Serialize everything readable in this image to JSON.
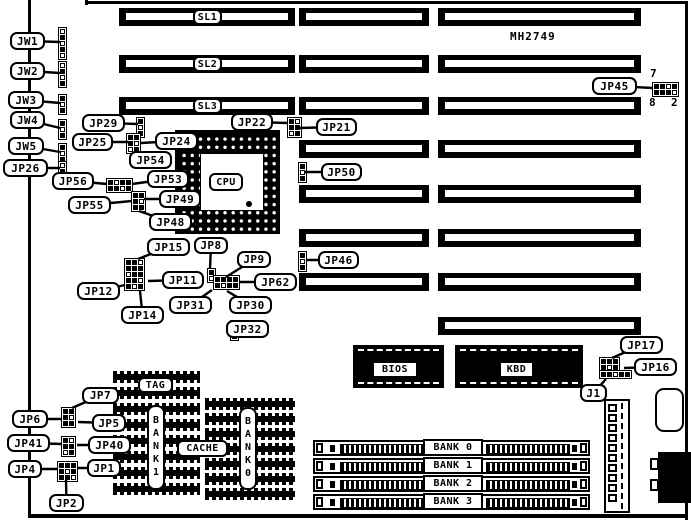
{
  "title": {
    "model": "MH2749"
  },
  "cpu": {
    "label": "CPU"
  },
  "callouts": [
    {
      "id": "jw1",
      "label": "JW1",
      "x": 10,
      "y": 32,
      "w": 35,
      "h": 18,
      "tx": 60,
      "ty": 42
    },
    {
      "id": "jw2",
      "label": "JW2",
      "x": 10,
      "y": 62,
      "w": 35,
      "h": 18,
      "tx": 60,
      "ty": 73
    },
    {
      "id": "jw3",
      "label": "JW3",
      "x": 8,
      "y": 91,
      "w": 36,
      "h": 18,
      "tx": 60,
      "ty": 103
    },
    {
      "id": "jw4",
      "label": "JW4",
      "x": 10,
      "y": 111,
      "w": 35,
      "h": 18,
      "tx": 60,
      "ty": 128
    },
    {
      "id": "jw5",
      "label": "JW5",
      "x": 8,
      "y": 137,
      "w": 36,
      "h": 18,
      "tx": 60,
      "ty": 152
    },
    {
      "id": "jp26",
      "label": "JP26",
      "x": 3,
      "y": 159,
      "w": 45,
      "h": 18,
      "tx": 60,
      "ty": 168
    },
    {
      "id": "jp29",
      "label": "JP29",
      "x": 82,
      "y": 114,
      "w": 43,
      "h": 18,
      "tx": 138,
      "ty": 124
    },
    {
      "id": "jp25",
      "label": "JP25",
      "x": 72,
      "y": 133,
      "w": 41,
      "h": 18,
      "tx": 128,
      "ty": 142
    },
    {
      "id": "jp24",
      "label": "JP24",
      "x": 155,
      "y": 132,
      "w": 43,
      "h": 18,
      "tx": 141,
      "ty": 143
    },
    {
      "id": "jp54",
      "label": "JP54",
      "x": 129,
      "y": 151,
      "w": 43,
      "h": 18,
      "tx": 135,
      "ty": 150
    },
    {
      "id": "jp56",
      "label": "JP56",
      "x": 52,
      "y": 172,
      "w": 42,
      "h": 18,
      "tx": 107,
      "ty": 184
    },
    {
      "id": "jp53",
      "label": "JP53",
      "x": 147,
      "y": 170,
      "w": 42,
      "h": 18,
      "tx": 132,
      "ty": 184
    },
    {
      "id": "jp55",
      "label": "JP55",
      "x": 68,
      "y": 196,
      "w": 43,
      "h": 18,
      "tx": 132,
      "ty": 201
    },
    {
      "id": "jp49",
      "label": "JP49",
      "x": 159,
      "y": 190,
      "w": 42,
      "h": 18,
      "tx": 144,
      "ty": 199
    },
    {
      "id": "jp48",
      "label": "JP48",
      "x": 149,
      "y": 213,
      "w": 43,
      "h": 18,
      "tx": 139,
      "ty": 211
    },
    {
      "id": "jp22",
      "label": "JP22",
      "x": 231,
      "y": 113,
      "w": 42,
      "h": 18,
      "tx": 288,
      "ty": 123
    },
    {
      "id": "jp21",
      "label": "JP21",
      "x": 316,
      "y": 118,
      "w": 41,
      "h": 18,
      "tx": 299,
      "ty": 128
    },
    {
      "id": "jp50",
      "label": "JP50",
      "x": 321,
      "y": 163,
      "w": 41,
      "h": 18,
      "tx": 305,
      "ty": 172
    },
    {
      "id": "jp46",
      "label": "JP46",
      "x": 318,
      "y": 251,
      "w": 41,
      "h": 18,
      "tx": 307,
      "ty": 260
    },
    {
      "id": "jp45",
      "label": "JP45",
      "x": 592,
      "y": 77,
      "w": 45,
      "h": 18,
      "tx": 653,
      "ty": 88
    },
    {
      "id": "jp15",
      "label": "JP15",
      "x": 147,
      "y": 238,
      "w": 43,
      "h": 18,
      "tx": 138,
      "ty": 259
    },
    {
      "id": "jp8",
      "label": "JP8",
      "x": 194,
      "y": 237,
      "w": 34,
      "h": 17,
      "tx": 210,
      "ty": 269
    },
    {
      "id": "jp9",
      "label": "JP9",
      "x": 237,
      "y": 251,
      "w": 34,
      "h": 17,
      "tx": 226,
      "ty": 277
    },
    {
      "id": "jp12",
      "label": "JP12",
      "x": 77,
      "y": 282,
      "w": 43,
      "h": 18,
      "tx": 125,
      "ty": 285
    },
    {
      "id": "jp11",
      "label": "JP11",
      "x": 162,
      "y": 271,
      "w": 42,
      "h": 18,
      "tx": 148,
      "ty": 281
    },
    {
      "id": "jp62",
      "label": "JP62",
      "x": 254,
      "y": 273,
      "w": 43,
      "h": 18,
      "tx": 239,
      "ty": 282
    },
    {
      "id": "jp14",
      "label": "JP14",
      "x": 121,
      "y": 306,
      "w": 43,
      "h": 18,
      "tx": 140,
      "ty": 291
    },
    {
      "id": "jp31",
      "label": "JP31",
      "x": 169,
      "y": 296,
      "w": 43,
      "h": 18,
      "tx": 212,
      "ty": 290
    },
    {
      "id": "jp30",
      "label": "JP30",
      "x": 229,
      "y": 296,
      "w": 43,
      "h": 18,
      "tx": 227,
      "ty": 291
    },
    {
      "id": "jp32",
      "label": "JP32",
      "x": 226,
      "y": 320,
      "w": 43,
      "h": 18,
      "tx": 238,
      "ty": 329
    },
    {
      "id": "jp7",
      "label": "JP7",
      "x": 82,
      "y": 387,
      "w": 37,
      "h": 17,
      "tx": 72,
      "ty": 408
    },
    {
      "id": "jp6",
      "label": "JP6",
      "x": 12,
      "y": 410,
      "w": 36,
      "h": 18,
      "tx": 62,
      "ty": 419
    },
    {
      "id": "jp5",
      "label": "JP5",
      "x": 92,
      "y": 414,
      "w": 34,
      "h": 18,
      "tx": 78,
      "ty": 422
    },
    {
      "id": "jp41",
      "label": "JP41",
      "x": 7,
      "y": 434,
      "w": 43,
      "h": 18,
      "tx": 62,
      "ty": 444
    },
    {
      "id": "jp40",
      "label": "JP40",
      "x": 88,
      "y": 436,
      "w": 43,
      "h": 18,
      "tx": 77,
      "ty": 445
    },
    {
      "id": "jp4",
      "label": "JP4",
      "x": 8,
      "y": 460,
      "w": 34,
      "h": 18,
      "tx": 58,
      "ty": 469
    },
    {
      "id": "jp1",
      "label": "JP1",
      "x": 87,
      "y": 459,
      "w": 34,
      "h": 18,
      "tx": 78,
      "ty": 468
    },
    {
      "id": "jp2",
      "label": "JP2",
      "x": 49,
      "y": 494,
      "w": 35,
      "h": 18,
      "tx": 66,
      "ty": 480
    },
    {
      "id": "jp17",
      "label": "JP17",
      "x": 620,
      "y": 336,
      "w": 43,
      "h": 18,
      "tx": 612,
      "ty": 358
    },
    {
      "id": "jp16",
      "label": "JP16",
      "x": 634,
      "y": 358,
      "w": 43,
      "h": 18,
      "tx": 624,
      "ty": 368
    },
    {
      "id": "j1",
      "label": "J1",
      "x": 580,
      "y": 384,
      "w": 27,
      "h": 18,
      "tx": 606,
      "ty": 379
    }
  ],
  "flat_labels": [
    {
      "id": "sl1",
      "label": "SL1",
      "x": 193,
      "y": 9,
      "w": 29,
      "h": 16,
      "s": "r"
    },
    {
      "id": "sl2",
      "label": "SL2",
      "x": 193,
      "y": 56,
      "w": 29,
      "h": 16,
      "s": "r"
    },
    {
      "id": "sl3",
      "label": "SL3",
      "x": 193,
      "y": 98,
      "w": 29,
      "h": 16,
      "s": "r"
    },
    {
      "id": "cpu",
      "label": "CPU",
      "x": 209,
      "y": 173,
      "w": 34,
      "h": 18,
      "s": "r"
    },
    {
      "id": "bios",
      "label": "BIOS",
      "x": 372,
      "y": 361,
      "w": 46,
      "h": 17,
      "s": "q"
    },
    {
      "id": "kbd",
      "label": "KBD",
      "x": 499,
      "y": 361,
      "w": 35,
      "h": 17,
      "s": "q"
    },
    {
      "id": "tag",
      "label": "TAG",
      "x": 138,
      "y": 377,
      "w": 35,
      "h": 16,
      "s": "r"
    },
    {
      "id": "cache",
      "label": "CACHE",
      "x": 177,
      "y": 440,
      "w": 51,
      "h": 17,
      "s": "r"
    },
    {
      "id": "bank1-vertical",
      "label": "BANK1",
      "x": 147,
      "y": 405,
      "w": 18,
      "h": 85,
      "s": "v"
    },
    {
      "id": "bank0-vertical",
      "label": "BANK0",
      "x": 239,
      "y": 407,
      "w": 18,
      "h": 83,
      "s": "v"
    },
    {
      "id": "simm-bank0",
      "label": "BANK 0",
      "x": 423,
      "y": 439,
      "w": 60,
      "h": 17,
      "s": "q"
    },
    {
      "id": "simm-bank1",
      "label": "BANK 1",
      "x": 423,
      "y": 457,
      "w": 60,
      "h": 17,
      "s": "q"
    },
    {
      "id": "simm-bank2",
      "label": "BANK 2",
      "x": 423,
      "y": 475,
      "w": 60,
      "h": 17,
      "s": "q"
    },
    {
      "id": "simm-bank3",
      "label": "BANK 3",
      "x": 423,
      "y": 493,
      "w": 60,
      "h": 17,
      "s": "q"
    },
    {
      "id": "model-number",
      "label": "MH2749",
      "x": 510,
      "y": 30,
      "w": 55,
      "h": 13,
      "s": "t"
    },
    {
      "id": "jp45-pin7",
      "label": "7",
      "x": 650,
      "y": 67,
      "w": 10,
      "h": 12,
      "s": "t"
    },
    {
      "id": "jp45-pin8",
      "label": "8",
      "x": 649,
      "y": 96,
      "w": 10,
      "h": 12,
      "s": "t"
    },
    {
      "id": "jp45-pin2",
      "label": "2",
      "x": 671,
      "y": 96,
      "w": 10,
      "h": 12,
      "s": "t"
    }
  ],
  "slots": {
    "h": 18,
    "rows": [
      {
        "id": "slot-row-sl1",
        "y": 8,
        "segs": [
          [
            119,
            176
          ],
          [
            299,
            130
          ],
          [
            438,
            203
          ]
        ]
      },
      {
        "id": "slot-row-sl2",
        "y": 55,
        "segs": [
          [
            119,
            176
          ],
          [
            299,
            130
          ],
          [
            438,
            203
          ]
        ]
      },
      {
        "id": "slot-row-sl3",
        "y": 97,
        "segs": [
          [
            119,
            176
          ],
          [
            299,
            130
          ],
          [
            438,
            203
          ]
        ]
      },
      {
        "id": "slot-row-4",
        "y": 140,
        "segs": [
          [
            299,
            130
          ],
          [
            438,
            203
          ]
        ]
      },
      {
        "id": "slot-row-5",
        "y": 185,
        "segs": [
          [
            299,
            130
          ],
          [
            438,
            203
          ]
        ]
      },
      {
        "id": "slot-row-6",
        "y": 229,
        "segs": [
          [
            299,
            130
          ],
          [
            438,
            203
          ]
        ]
      },
      {
        "id": "slot-row-7",
        "y": 273,
        "segs": [
          [
            299,
            130
          ],
          [
            438,
            203
          ]
        ]
      },
      {
        "id": "slot-row-8",
        "y": 317,
        "segs": [
          [
            438,
            203
          ]
        ]
      }
    ]
  },
  "jumpers": [
    {
      "id": "jw1-pins",
      "x": 58,
      "y": 27,
      "cell": 5,
      "pat": [
        "0",
        "1",
        "0",
        "1",
        "0"
      ]
    },
    {
      "id": "jw2-pins",
      "x": 58,
      "y": 61,
      "cell": 5,
      "pat": [
        "0",
        "1",
        "0",
        "1"
      ]
    },
    {
      "id": "jw3-pins",
      "x": 58,
      "y": 94,
      "cell": 5,
      "pat": [
        "1",
        "0",
        "1"
      ]
    },
    {
      "id": "jw4-pins",
      "x": 58,
      "y": 119,
      "cell": 5,
      "pat": [
        "1",
        "0",
        "1"
      ]
    },
    {
      "id": "jw5-pins",
      "x": 58,
      "y": 143,
      "cell": 5,
      "pat": [
        "1",
        "0",
        "1"
      ]
    },
    {
      "id": "jp26-pins",
      "x": 58,
      "y": 161,
      "cell": 5,
      "pat": [
        "0",
        "1",
        "0"
      ]
    },
    {
      "id": "jp29-pins",
      "x": 136,
      "y": 117,
      "cell": 5,
      "pat": [
        "1",
        "0",
        "1"
      ]
    },
    {
      "id": "jp25-jp24-pins",
      "x": 126,
      "y": 133,
      "cell": 5,
      "pat": [
        "11",
        "10",
        "01"
      ]
    },
    {
      "id": "jp56-jp53-pins",
      "x": 106,
      "y": 178,
      "cell": 5,
      "pat": [
        "1011",
        "1101"
      ]
    },
    {
      "id": "jp49-jp48-pins",
      "x": 131,
      "y": 191,
      "cell": 5,
      "pat": [
        "11",
        "10",
        "11"
      ]
    },
    {
      "id": "jp22-jp21-pins",
      "x": 287,
      "y": 117,
      "cell": 5,
      "pat": [
        "10",
        "11",
        "01"
      ]
    },
    {
      "id": "jp50-pins",
      "x": 298,
      "y": 162,
      "cell": 5,
      "pat": [
        "1",
        "0",
        "1"
      ]
    },
    {
      "id": "jp46-pins",
      "x": 298,
      "y": 251,
      "cell": 5,
      "pat": [
        "1",
        "0",
        "1"
      ]
    },
    {
      "id": "jp45-pins",
      "x": 652,
      "y": 82,
      "cell": 5,
      "pat": [
        "1101",
        "1110"
      ]
    },
    {
      "id": "jp15-block-pins",
      "x": 124,
      "y": 258,
      "cell": 5,
      "pat": [
        "110",
        "111",
        "011",
        "110",
        "101"
      ]
    },
    {
      "id": "jp8-pins",
      "x": 207,
      "y": 268,
      "cell": 5,
      "pat": [
        "1",
        "0"
      ]
    },
    {
      "id": "jp62-block-pins",
      "x": 213,
      "y": 275,
      "cell": 5,
      "pat": [
        "1111",
        "1011"
      ]
    },
    {
      "id": "jp32-pins",
      "x": 230,
      "y": 320,
      "cell": 5,
      "pat": [
        "1",
        "0",
        "1"
      ]
    },
    {
      "id": "j1-header-pins",
      "x": 599,
      "y": 357,
      "cell": 5,
      "pat": [
        "111",
        "101"
      ]
    },
    {
      "id": "j1-header-row",
      "x": 599,
      "y": 370,
      "cell": 5,
      "pat": [
        "11011"
      ]
    },
    {
      "id": "jp7-jp6-jp5-pins",
      "x": 61,
      "y": 407,
      "cell": 5,
      "pat": [
        "11",
        "10",
        "11"
      ]
    },
    {
      "id": "jp41-jp40-pins",
      "x": 61,
      "y": 436,
      "cell": 5,
      "pat": [
        "10",
        "11",
        "01"
      ]
    },
    {
      "id": "jp4-jp1-jp2-pins",
      "x": 57,
      "y": 461,
      "cell": 5,
      "pat": [
        "111",
        "101",
        "110"
      ]
    }
  ],
  "simms": {
    "x": 313,
    "w": 277,
    "h": 16,
    "ys": [
      440,
      458,
      476,
      494
    ]
  },
  "cache_blocks": {
    "left": {
      "x": 113,
      "y": 371,
      "w": 87,
      "rows": 8,
      "pitch": 16
    },
    "right": {
      "x": 205,
      "y": 398,
      "w": 90,
      "rows": 7,
      "pitch": 15
    }
  },
  "power": {
    "pins": 10
  }
}
